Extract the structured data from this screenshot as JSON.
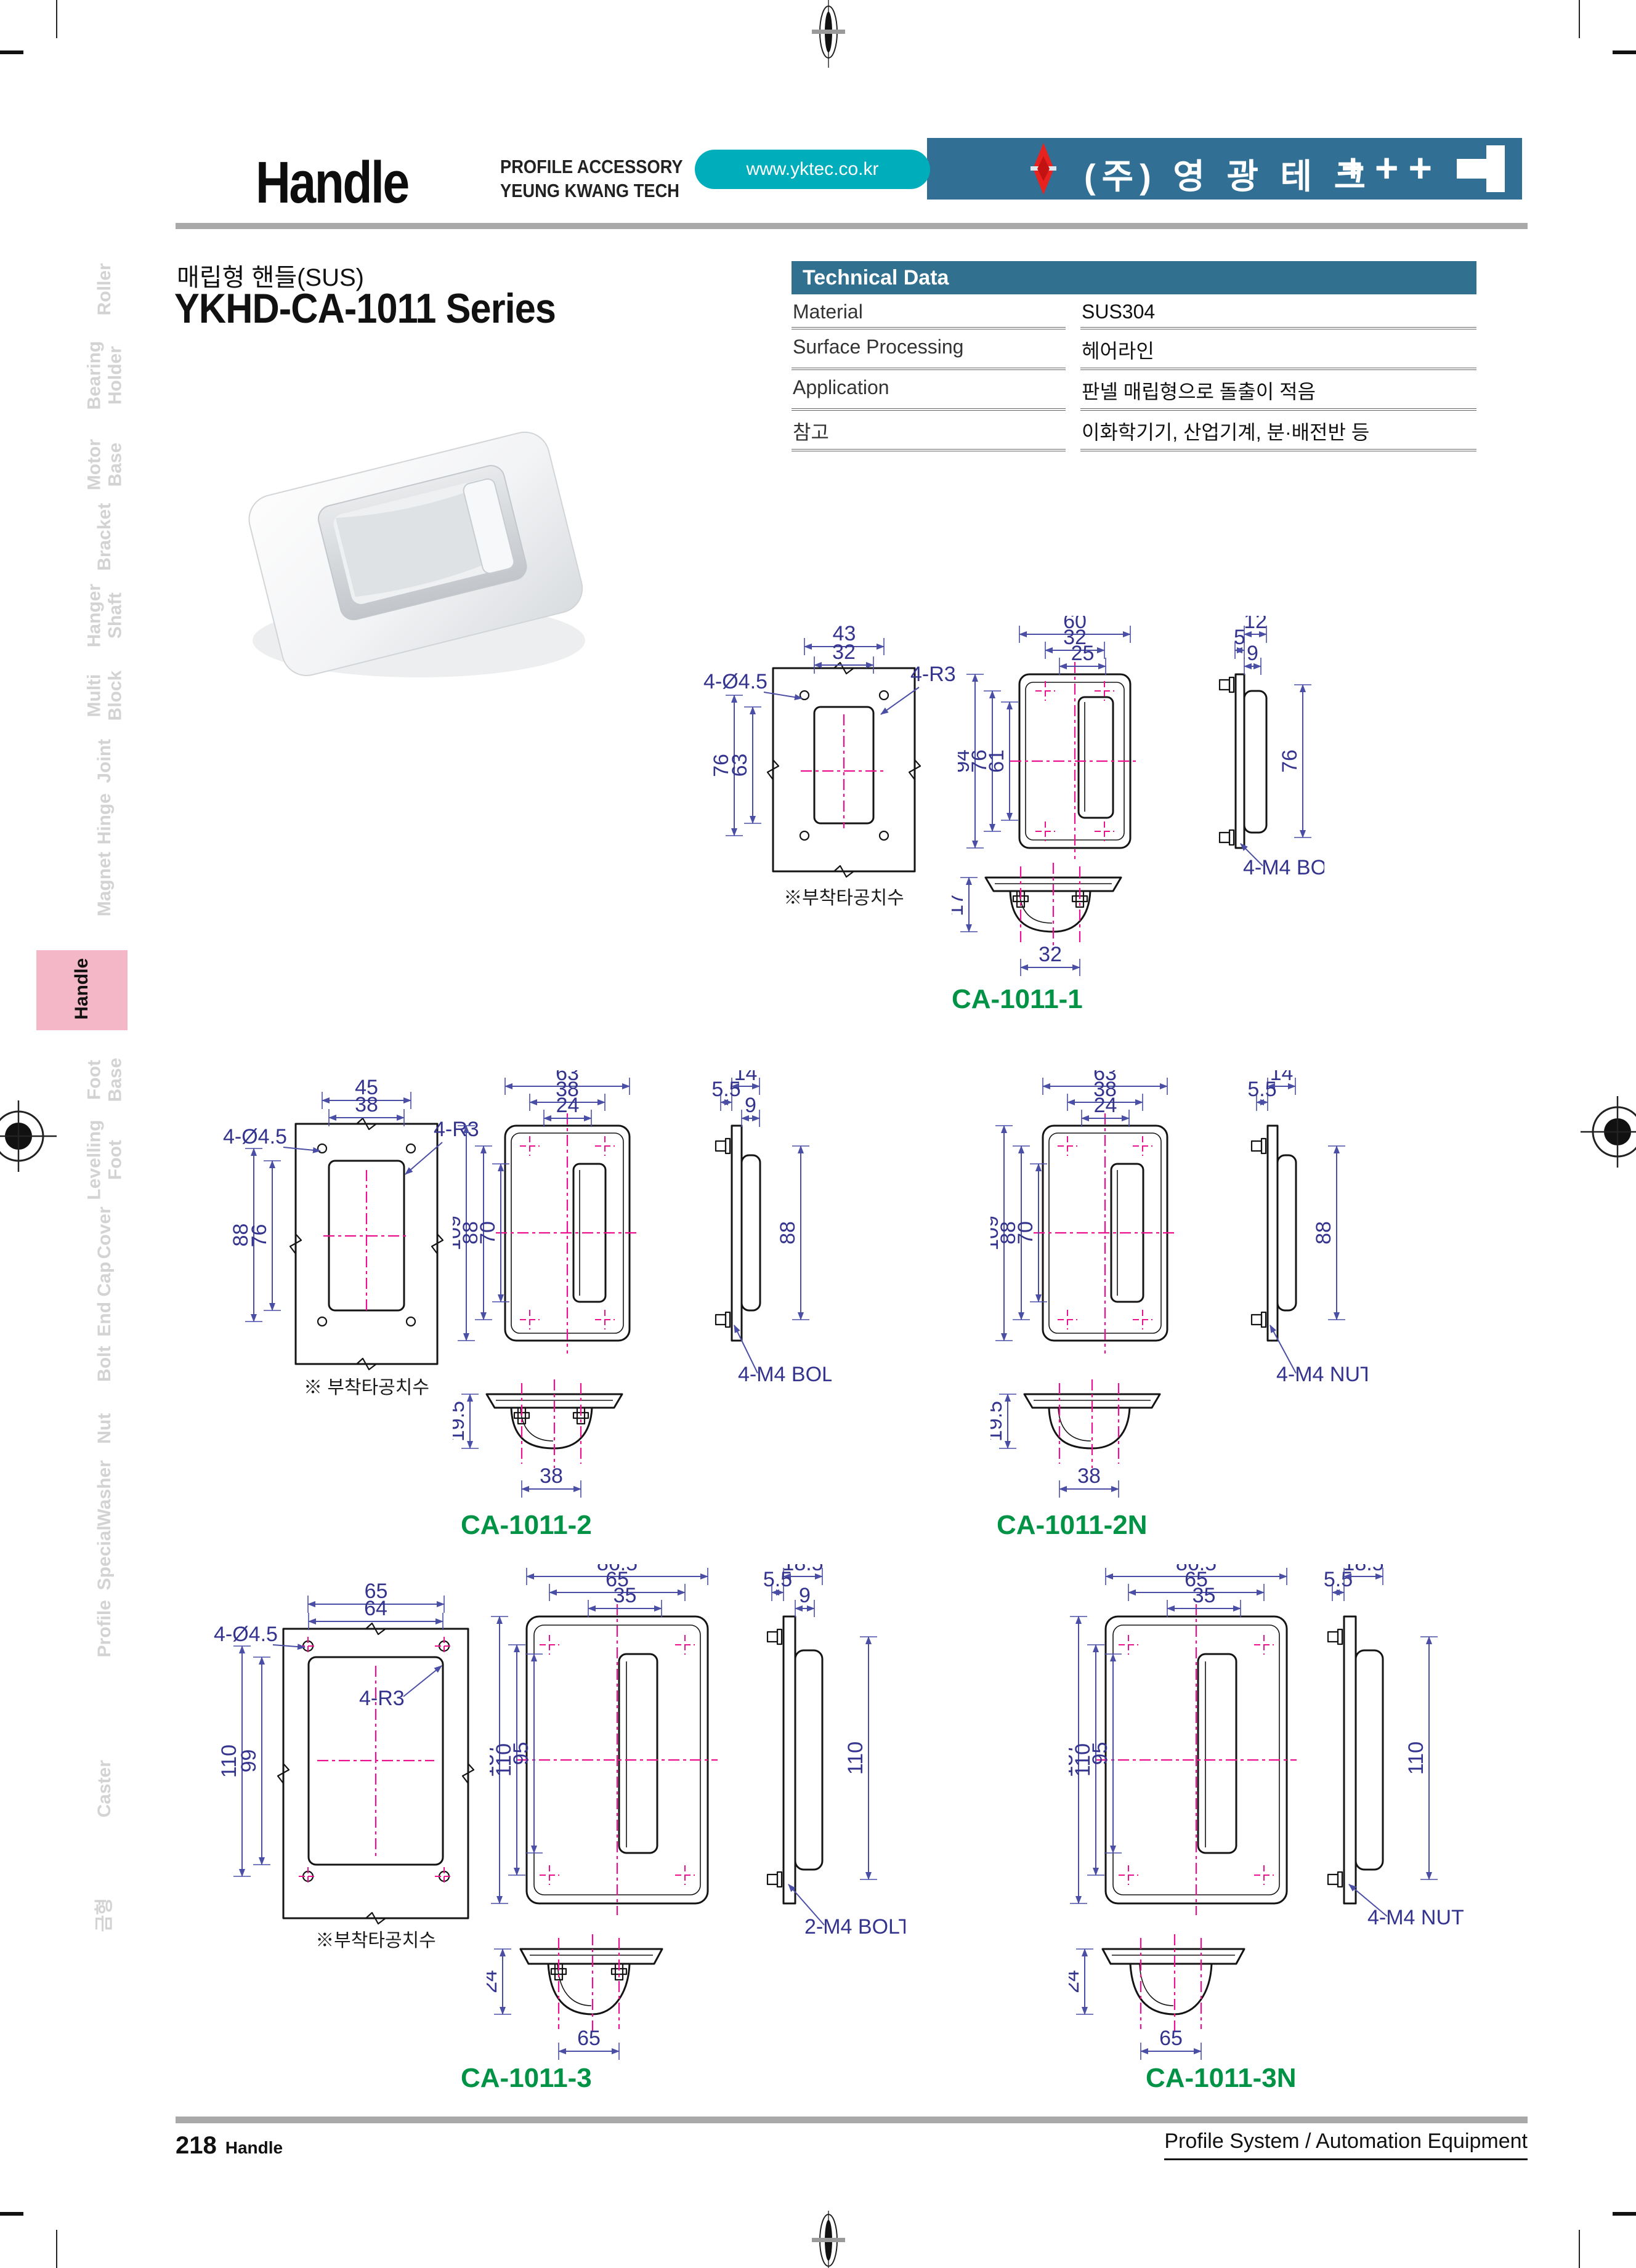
{
  "header": {
    "title": "Handle",
    "subtitle_line1": "PROFILE ACCESSORY",
    "subtitle_line2": "YEUNG KWANG TECH",
    "url": "www.yktec.co.kr",
    "company": "(주) 영 광 테 크",
    "plus_marks": "+++",
    "band_color": "#316f94",
    "pill_color": "#00adba",
    "logo_color": "#e8231f"
  },
  "product": {
    "title_kr": "매립형 핸들(SUS)",
    "series": "YKHD-CA-1011 Series"
  },
  "technical_data": {
    "header": "Technical Data",
    "rows": [
      {
        "label": "Material",
        "value": "SUS304"
      },
      {
        "label": "Surface Processing",
        "value": "헤어라인"
      },
      {
        "label": "Application",
        "value": "판넬 매립형으로 돌출이 적음"
      },
      {
        "label": "참고",
        "value": "이화학기기, 산업기계, 분·배전반 등"
      }
    ]
  },
  "sidebar": {
    "active": "Handle",
    "active_color": "#f3b7c7",
    "items": [
      {
        "lines": [
          "Roller"
        ]
      },
      {
        "lines": [
          "Bearing",
          "Holder"
        ]
      },
      {
        "lines": [
          "Motor",
          "Base"
        ]
      },
      {
        "lines": [
          "Bracket"
        ]
      },
      {
        "lines": [
          "Hanger",
          "Shaft"
        ]
      },
      {
        "lines": [
          "Multi",
          "Block"
        ]
      },
      {
        "lines": [
          "Joint"
        ]
      },
      {
        "lines": [
          "Hinge"
        ]
      },
      {
        "lines": [
          "Magnet"
        ]
      },
      {
        "lines": [
          "Handle"
        ],
        "active": true
      },
      {
        "lines": [
          "Foot",
          "Base"
        ]
      },
      {
        "lines": [
          "Levelling",
          "Foot"
        ]
      },
      {
        "lines": [
          "Cover"
        ]
      },
      {
        "lines": [
          "End Cap"
        ]
      },
      {
        "lines": [
          "Bolt"
        ]
      },
      {
        "lines": [
          "Nut"
        ]
      },
      {
        "lines": [
          "Washer"
        ]
      },
      {
        "lines": [
          "Special"
        ]
      },
      {
        "lines": [
          "Profile"
        ]
      },
      {
        "lines": [
          "Caster"
        ]
      },
      {
        "lines": [
          "금형"
        ]
      }
    ]
  },
  "dw": {
    "c1": {
      "label": "CA-1011-1",
      "note": "※부착타공치수",
      "t": {
        "w1": "43",
        "w2": "32",
        "h1": "76",
        "h2": "63",
        "holes": "4-Ø4.5",
        "rad": "4-R3"
      },
      "f": {
        "w1": "60",
        "w2": "32",
        "w3": "25",
        "h1": "94",
        "h2": "76",
        "h3": "61"
      },
      "s": {
        "d1": "12",
        "d2": "5",
        "d3": "9",
        "h": "76",
        "callout": "4-M4 BOLT"
      },
      "b": {
        "h": "17",
        "w": "32"
      }
    },
    "c2": {
      "label": "CA-1011-2",
      "note": "※ 부착타공치수",
      "t": {
        "w1": "45",
        "w2": "38",
        "h1": "88",
        "h2": "76",
        "holes": "4-Ø4.5",
        "rad": "4-R3"
      },
      "f": {
        "w1": "63",
        "w2": "38",
        "w3": "24",
        "h1": "109",
        "h2": "88",
        "h3": "70"
      },
      "s": {
        "d1": "14",
        "d2": "5.5",
        "d3": "9",
        "h": "88",
        "callout": "4-M4 BOLT"
      },
      "b": {
        "h": "19.5",
        "w": "38"
      }
    },
    "c2n": {
      "label": "CA-1011-2N",
      "f": {
        "w1": "63",
        "w2": "38",
        "w3": "24",
        "h1": "109",
        "h2": "88",
        "h3": "70"
      },
      "s": {
        "d1": "14",
        "d2": "5.5",
        "h": "88",
        "callout": "4-M4 NUT"
      },
      "b": {
        "h": "19.5",
        "w": "38"
      }
    },
    "c3": {
      "label": "CA-1011-3",
      "note": "※부착타공치수",
      "t": {
        "w1": "65",
        "w2": "64",
        "h1": "110",
        "h2": "99",
        "holes": "4-Ø4.5",
        "rad": "4-R3"
      },
      "f": {
        "w1": "86.5",
        "w2": "65",
        "w3": "35",
        "h1": "137",
        "h2": "110",
        "h3": "95"
      },
      "s": {
        "d1": "18.5",
        "d2": "5.5",
        "d3": "9",
        "h": "110",
        "callout": "2-M4 BOLT"
      },
      "b": {
        "h": "24",
        "w": "65"
      }
    },
    "c3n": {
      "label": "CA-1011-3N",
      "f": {
        "w1": "86.5",
        "w2": "65",
        "w3": "35",
        "h1": "137",
        "h2": "110",
        "h3": "95"
      },
      "s": {
        "d1": "5.5",
        "d2": "18.5",
        "h": "110",
        "callout": "4-M4 NUT"
      },
      "b": {
        "h": "24",
        "w": "65"
      }
    }
  },
  "footer": {
    "page_number": "218",
    "section": "Handle",
    "right": "Profile System / Automation Equipment"
  }
}
